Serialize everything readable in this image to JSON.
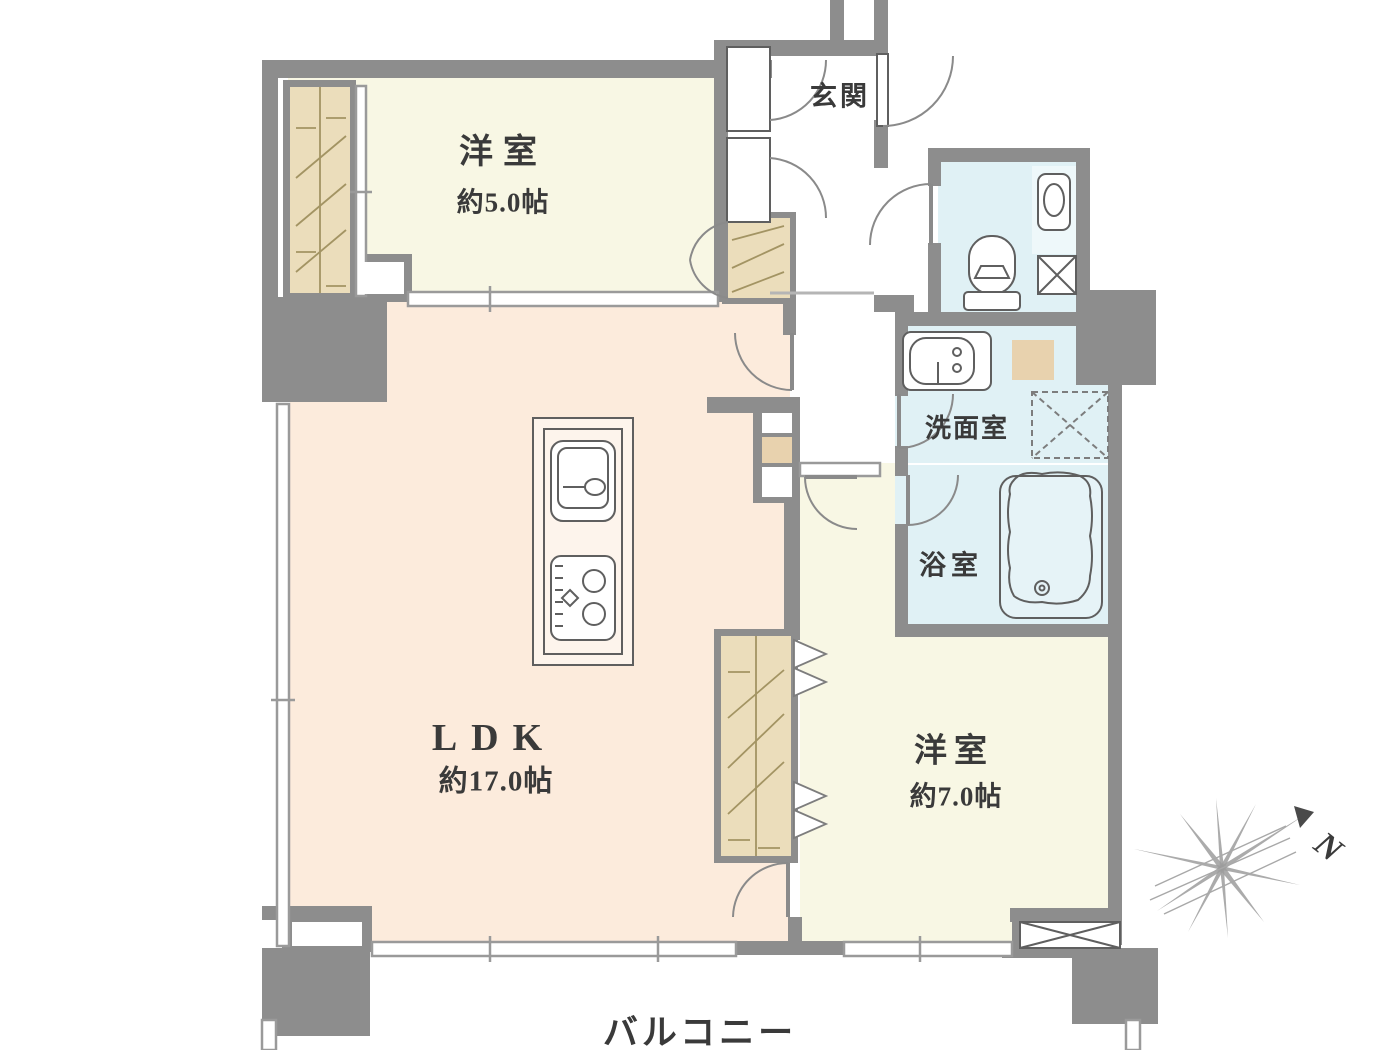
{
  "rooms": {
    "bedroom_small": {
      "name": "洋室",
      "area": "約5.0帖"
    },
    "entrance": {
      "name": "玄関"
    },
    "ldk": {
      "name": "LDK",
      "area": "約17.0帖"
    },
    "washroom": {
      "name": "洗面室"
    },
    "bathroom": {
      "name": "浴室"
    },
    "bedroom_large": {
      "name": "洋室",
      "area": "約7.0帖"
    },
    "balcony": {
      "name": "バルコニー"
    }
  },
  "compass": {
    "north_label": "N"
  },
  "colors": {
    "wall": "#8d8d8d",
    "ldk_floor": "#fcebdc",
    "bedroom_floor": "#f8f7e4",
    "wet_floor": "#e0f1f5",
    "closet": "#ebddbb",
    "accent_tan": "#e8d2ae",
    "outline": "#5f5f5f",
    "window_line": "#9a9a9a",
    "door_line": "#8a8a8a",
    "hatch": "#a39463",
    "compass": "#9c9c9c",
    "text": "#3a3a3a"
  }
}
